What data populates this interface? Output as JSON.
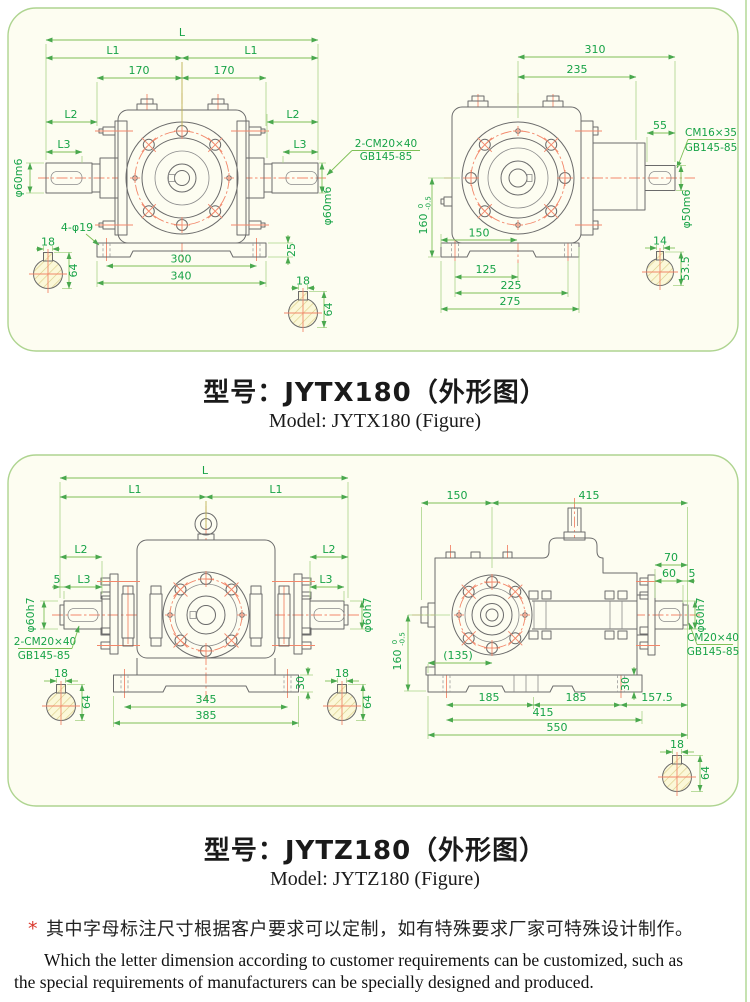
{
  "panel1": {
    "title_cn": "型号：JYTX180（外形图）",
    "title_en": "Model: JYTX180 (Figure)",
    "front": {
      "dim_L": "L",
      "dim_L1_left": "L1",
      "dim_L1_right": "L1",
      "dim_170_left": "170",
      "dim_170_right": "170",
      "dim_L2_left": "L2",
      "dim_L3_left": "L3",
      "dim_L2_right": "L2",
      "dim_L3_right": "L3",
      "shaft_dia_left": "φ60m6",
      "shaft_dia_right": "φ60m6",
      "key_note_l1": "2-CM20×40",
      "key_note_l2": "GB145-85",
      "holes_note": "4-φ19",
      "dim_25": "25",
      "dim_300": "300",
      "dim_340": "340",
      "sec_left": {
        "key_w": "18",
        "height": "64"
      },
      "sec_right": {
        "key_w": "18",
        "height": "64"
      }
    },
    "side": {
      "dim_310": "310",
      "dim_235": "235",
      "dim_55": "55",
      "key_note_l1": "CM16×35",
      "key_note_l2": "GB145-85",
      "shaft_dia": "φ50m6",
      "dim_160": "160",
      "tol_hi": "0",
      "tol_lo": "-0.5",
      "dim_150": "150",
      "dim_125": "125",
      "dim_225": "225",
      "dim_275": "275",
      "sec": {
        "key_w": "14",
        "height": "53.5"
      }
    }
  },
  "panel2": {
    "title_cn": "型号：JYTZ180（外形图）",
    "title_en": "Model: JYTZ180 (Figure)",
    "front": {
      "dim_L": "L",
      "dim_L1_left": "L1",
      "dim_L1_right": "L1",
      "dim_L2_left": "L2",
      "dim_L3_left": "L3",
      "dim_5": "5",
      "dim_L2_right": "L2",
      "dim_L3_right": "L3",
      "shaft_dia_left": "φ60h7",
      "shaft_dia_right": "φ60h7",
      "key_note_l1": "2-CM20×40",
      "key_note_l2": "GB145-85",
      "dim_345": "345",
      "dim_385": "385",
      "dim_30": "30",
      "sec_left": {
        "key_w": "18",
        "height": "64"
      },
      "sec_right": {
        "key_w": "18",
        "height": "64"
      }
    },
    "side": {
      "dim_150": "150",
      "dim_415_top": "415",
      "dim_70": "70",
      "dim_60": "60",
      "dim_5": "5",
      "shaft_dia": "φ60h7",
      "key_note_l1": "CM20×40",
      "key_note_l2": "GB145-85",
      "dim_160": "160",
      "tol_hi": "0",
      "tol_lo": "-0.5",
      "dim_135": "(135)",
      "dim_185_left": "185",
      "dim_185_right": "185",
      "dim_157_5": "157.5",
      "dim_415": "415",
      "dim_550": "550",
      "dim_30": "30",
      "sec": {
        "key_w": "18",
        "height": "64"
      }
    }
  },
  "note": {
    "mark": "*",
    "cn": "其中字母标注尺寸根据客户要求可以定制，如有特殊要求厂家可特殊设计制作。",
    "en_line1": "Which the letter dimension according to customer requirements can be customized, such as",
    "en_line2": "the special requirements of manufacturers can be specially designed and produced."
  }
}
